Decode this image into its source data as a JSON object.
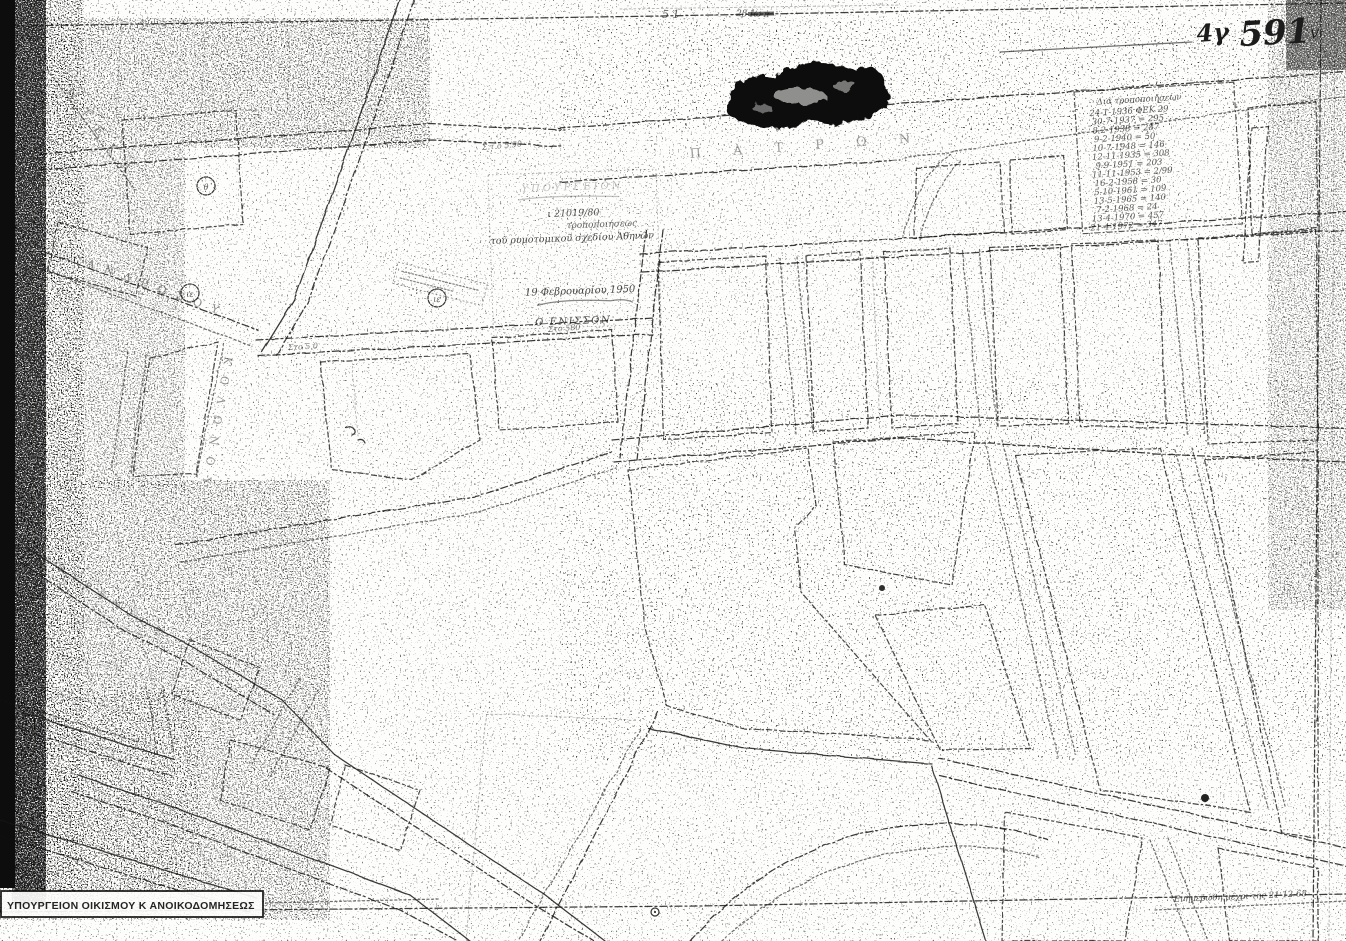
{
  "sheet_codes": {
    "prefix": "4γ",
    "number": "591",
    "check_mark": "v"
  },
  "revision_log": {
    "title": "Διά τροποποιήσεων",
    "entries": [
      "24-1-1936 ΦΕΚ 29",
      "30-7-1937 = 295",
      "8-2-1938 = 287",
      "9-2-1940 = 50",
      "10-7-1948 = 146",
      "12-11-1935 = 308",
      "9-9-1951 = 203",
      "11-11-1953 = 2/99",
      "16-2-1958 = 30",
      "5-10-1961 = 109",
      "13-5-1965 = 140",
      "7-2-1968 = 24",
      "13-4-1970 = 457",
      "21-4-1972 = 347"
    ]
  },
  "approval_stamp": {
    "header_faint": "ΥΠΟΥΡΓΕΙΟΝ",
    "protocol": "ι 21019/80",
    "line1": "τροποποιήσεως",
    "line2": "τοῦ ρυμοτομικοῦ σχεδίου Ἀθηνῶν",
    "date_line": "19 Φεβρουαρίου 1950",
    "signature": "Ο ΕΝΙΣΣΟΝ"
  },
  "footer": {
    "ministry": "ΥΠΟΥΡΓΕΙΟΝ ΟΙΚΙΣΜΟΥ Κ ΑΝΟΙΚΟΔΟΜΗΣΕΩΣ",
    "update_note": "Ενημερώθη μέχρι της 21-12-68"
  },
  "street_labels": [
    {
      "text": "Ν Τ Ε Κ Α"
    },
    {
      "text": "Α Ν Δ Ρ Ω Σ Ο Υ"
    },
    {
      "text": "Κ Ο Λ Ω Ν Ο Υ"
    },
    {
      "text": "Π Α Τ Ρ Ω Ν"
    },
    {
      "text": "Α Θ Υ Ρ Ε Ν Τ Ο Σ"
    }
  ],
  "dimension_notes": [
    {
      "text": "Σ.τ.ο 5.90"
    },
    {
      "text": "Στο 5.0"
    },
    {
      "text": "Στο 580"
    }
  ],
  "block_markers": [
    {
      "label": "θ"
    },
    {
      "label": "ιε"
    },
    {
      "label": "ιε"
    }
  ],
  "margin_marks": {
    "top_left_faint": "Α Γ Σ Ο 3",
    "top_center_a": "5 1",
    "top_center_b": "2β Ιω π"
  }
}
